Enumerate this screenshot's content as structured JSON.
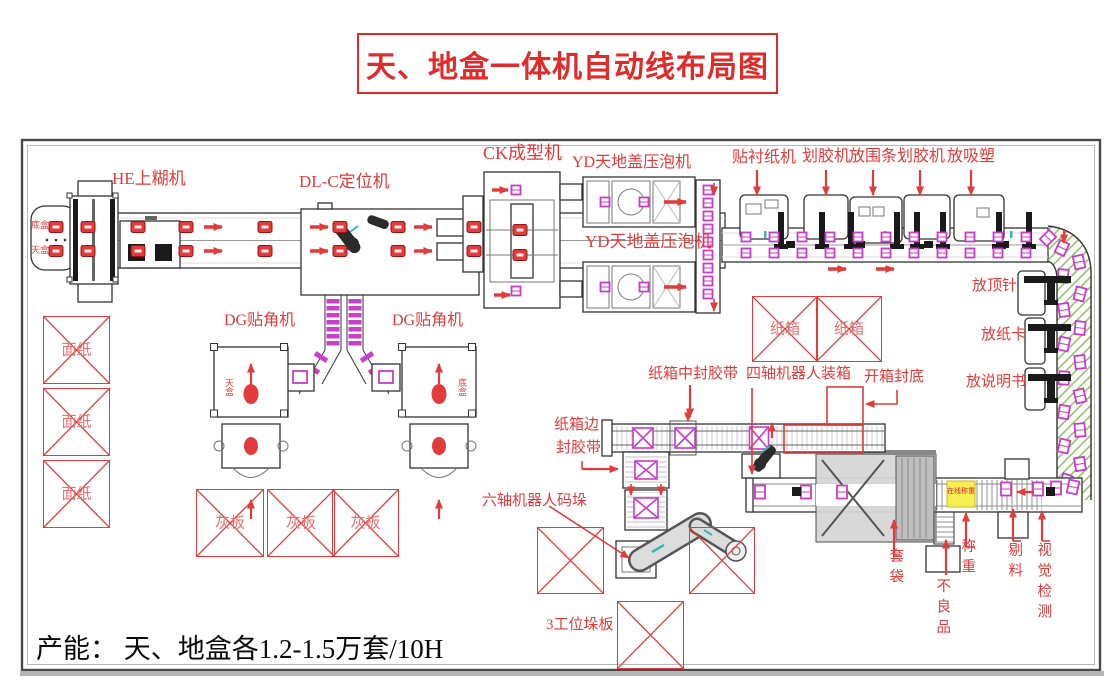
{
  "title": "天、地盒一体机自动线布局图",
  "capacity": "产能： 天、地盒各1.2-1.5万套/10H",
  "colors": {
    "accent_red": "#e23b3b",
    "item_magenta": "#c83cc8",
    "hatch_green": "#79b344",
    "weigh_yellow": "#f7ee52"
  },
  "labels": {
    "he": "HE上糊机",
    "dlc": "DL-C定位机",
    "ck": "CK成型机",
    "yd": "YD天地盖压泡机",
    "lining": "贴衬纸机",
    "scorer": "划胶机",
    "rim": "放围条",
    "blister": "放吸塑",
    "pin": "放顶针",
    "card": "放纸卡",
    "manual": "放说明书",
    "dg": "DG贴角机",
    "mid_tape": "纸箱中封胶带",
    "four_axis": "四轴机器人装箱",
    "open_seal": "开箱封底",
    "edge_tape_1": "纸箱边",
    "edge_tape_2": "封胶带",
    "six_axis": "六轴机器人码垛",
    "pallet3": "3工位垛板",
    "bagging": "套袋",
    "defective": "不良品",
    "weigh": "称重",
    "reject": "剔料",
    "vision": "视觉检测",
    "inline_weigh": "在线称重",
    "bottom_box": "底盒",
    "top_box": "天盒",
    "face_paper": "面纸",
    "gray_board": "灰板",
    "carton": "纸箱"
  }
}
